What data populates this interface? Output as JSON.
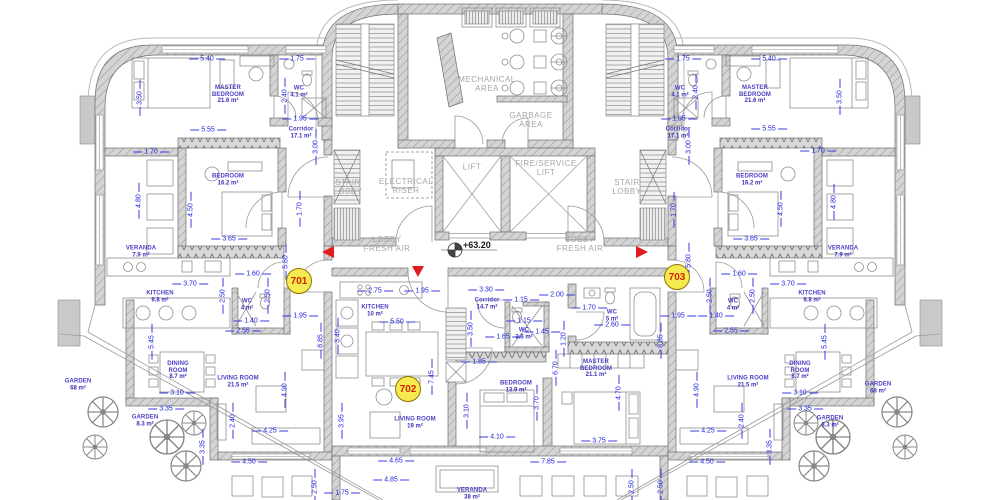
{
  "title": "residential floor plan",
  "level": {
    "text": "+63.20"
  },
  "colors": {
    "dimension_text": "#1d1de0",
    "room_label": "#4a3fc4",
    "core_label": "#a6a6a6",
    "wall_fill": "#d4d4d4",
    "unit_badge_bg": "#f6ea51",
    "unit_badge_border": "#8f7400",
    "unit_badge_text": "#d42300",
    "marker_red": "#e01c1c"
  },
  "units": [
    {
      "no": "701",
      "x": 299,
      "y": 281
    },
    {
      "no": "702",
      "x": 408,
      "y": 389
    },
    {
      "no": "703",
      "x": 677,
      "y": 277
    }
  ],
  "core_labels": [
    {
      "t": "MECHANICAL\nAREA",
      "x": 487,
      "y": 84
    },
    {
      "t": "GARBAGE\nAREA",
      "x": 531,
      "y": 120
    },
    {
      "t": "LIFT",
      "x": 472,
      "y": 167
    },
    {
      "t": "FIRE/SERVICE\nLIFT",
      "x": 546,
      "y": 168
    },
    {
      "t": "STAIR\nLOBBY",
      "x": 348,
      "y": 187
    },
    {
      "t": "ELECTRICAL\nRISER",
      "x": 406,
      "y": 186
    },
    {
      "t": "STAIR\nLOBBY",
      "x": 627,
      "y": 187
    },
    {
      "t": "LOBBY\nFRESH AIR",
      "x": 387,
      "y": 244
    },
    {
      "t": "LOBBY\nFRESH AIR",
      "x": 580,
      "y": 244
    }
  ],
  "rooms": [
    {
      "n": "MASTER\nBEDROOM",
      "a": "21.6 m²",
      "x": 228,
      "y": 95
    },
    {
      "n": "WC",
      "a": "4.1 m²",
      "x": 299,
      "y": 92
    },
    {
      "n": "Corridor",
      "a": "17.1 m²",
      "x": 301,
      "y": 133
    },
    {
      "n": "BEDROOM",
      "a": "16.2 m²",
      "x": 228,
      "y": 180
    },
    {
      "n": "VERANDA",
      "a": "7.9 m²",
      "x": 141,
      "y": 252
    },
    {
      "n": "KITCHEN",
      "a": "9.8 m²",
      "x": 160,
      "y": 297
    },
    {
      "n": "WC",
      "a": "4 m²",
      "x": 247,
      "y": 305
    },
    {
      "n": "DINING\nROOM",
      "a": "8.7 m²",
      "x": 178,
      "y": 371
    },
    {
      "n": "LIVING ROOM",
      "a": "21.5 m²",
      "x": 238,
      "y": 382
    },
    {
      "n": "GARDEN",
      "a": "68 m²",
      "x": 78,
      "y": 385
    },
    {
      "n": "GARDEN",
      "a": "8.3 m²",
      "x": 145,
      "y": 421
    },
    {
      "n": "KITCHEN",
      "a": "10 m²",
      "x": 375,
      "y": 311
    },
    {
      "n": "Corridor",
      "a": "14.7 m²",
      "x": 487,
      "y": 304
    },
    {
      "n": "WC",
      "a": "3.6 m²",
      "x": 524,
      "y": 334
    },
    {
      "n": "WC",
      "a": "5 m²",
      "x": 612,
      "y": 316
    },
    {
      "n": "BEDROOM",
      "a": "13.9 m²",
      "x": 516,
      "y": 387
    },
    {
      "n": "MASTER\nBEDROOM",
      "a": "21.1 m²",
      "x": 596,
      "y": 369
    },
    {
      "n": "LIVING ROOM",
      "a": "19 m²",
      "x": 415,
      "y": 423
    },
    {
      "n": "VERANDA",
      "a": "38 m²",
      "x": 472,
      "y": 494
    },
    {
      "n": "WC",
      "a": "4.1 m²",
      "x": 680,
      "y": 92
    },
    {
      "n": "MASTER\nBEDROOM",
      "a": "21.6 m²",
      "x": 755,
      "y": 95
    },
    {
      "n": "Corridor",
      "a": "17.1 m²",
      "x": 678,
      "y": 133
    },
    {
      "n": "BEDROOM",
      "a": "16.2 m²",
      "x": 752,
      "y": 180
    },
    {
      "n": "VERANDA",
      "a": "7.9 m²",
      "x": 843,
      "y": 252
    },
    {
      "n": "KITCHEN",
      "a": "9.8 m²",
      "x": 812,
      "y": 297
    },
    {
      "n": "WC",
      "a": "4 m²",
      "x": 733,
      "y": 305
    },
    {
      "n": "DINING\nROOM",
      "a": "8.7 m²",
      "x": 800,
      "y": 371
    },
    {
      "n": "LIVING ROOM",
      "a": "21.5 m²",
      "x": 748,
      "y": 382
    },
    {
      "n": "GARDEN",
      "a": "68 m²",
      "x": 878,
      "y": 388
    },
    {
      "n": "GARDEN",
      "a": "8.3 m²",
      "x": 830,
      "y": 422
    }
  ],
  "dimensions": [
    [
      "5.40",
      207,
      59,
      0
    ],
    [
      "1.75",
      297,
      59,
      0
    ],
    [
      "3.50",
      140,
      98,
      1
    ],
    [
      "2.40",
      285,
      96,
      1
    ],
    [
      "1.95",
      300,
      119,
      0
    ],
    [
      "5.55",
      208,
      130,
      0
    ],
    [
      "3.00",
      316,
      147,
      1
    ],
    [
      "1.70",
      151,
      152,
      0
    ],
    [
      "4.80",
      139,
      201,
      1
    ],
    [
      "4.50",
      191,
      210,
      1
    ],
    [
      "1.70",
      300,
      209,
      1
    ],
    [
      "3.65",
      229,
      239,
      0
    ],
    [
      "5.80",
      286,
      262,
      1
    ],
    [
      "1.60",
      253,
      274,
      0
    ],
    [
      "3.70",
      190,
      284,
      0
    ],
    [
      "2.50",
      223,
      296,
      1
    ],
    [
      "2.50",
      268,
      296,
      1
    ],
    [
      "1.40",
      251,
      321,
      0
    ],
    [
      "1.95",
      300,
      316,
      0
    ],
    [
      "2.55",
      243,
      331,
      0
    ],
    [
      "5.45",
      152,
      342,
      1
    ],
    [
      "8.85",
      321,
      341,
      1
    ],
    [
      "3.10",
      177,
      393,
      0
    ],
    [
      "3.35",
      166,
      409,
      0
    ],
    [
      "4.90",
      285,
      390,
      1
    ],
    [
      "2.40",
      233,
      421,
      1
    ],
    [
      "4.25",
      270,
      431,
      0
    ],
    [
      "3.35",
      203,
      447,
      1
    ],
    [
      "4.50",
      249,
      462,
      0
    ],
    [
      "2.50",
      315,
      487,
      1
    ],
    [
      "1.75",
      342,
      493,
      0
    ],
    [
      "2.75",
      375,
      291,
      0
    ],
    [
      "1.95",
      422,
      291,
      0
    ],
    [
      "3.30",
      486,
      290,
      0
    ],
    [
      "5.50",
      397,
      322,
      0
    ],
    [
      "3.40",
      338,
      336,
      1
    ],
    [
      "3.50",
      471,
      329,
      1
    ],
    [
      "1.15",
      521,
      300,
      0
    ],
    [
      "2.00",
      557,
      295,
      0
    ],
    [
      "1.65",
      503,
      337,
      0
    ],
    [
      "1.15",
      524,
      321,
      0
    ],
    [
      "1.45",
      542,
      332,
      0
    ],
    [
      "1.85",
      479,
      362,
      0
    ],
    [
      "1.20",
      564,
      339,
      1
    ],
    [
      "1.70",
      589,
      308,
      0
    ],
    [
      "2.60",
      612,
      325,
      0
    ],
    [
      "7.45",
      432,
      377,
      1
    ],
    [
      "3.10",
      467,
      411,
      1
    ],
    [
      "6.70",
      556,
      368,
      1
    ],
    [
      "3.95",
      342,
      421,
      1
    ],
    [
      "3.70",
      537,
      403,
      1
    ],
    [
      "4.10",
      497,
      437,
      0
    ],
    [
      "4.70",
      619,
      393,
      1
    ],
    [
      "3.75",
      599,
      441,
      0
    ],
    [
      "7.85",
      548,
      462,
      0
    ],
    [
      "4.65",
      396,
      461,
      0
    ],
    [
      "4.85",
      391,
      480,
      0
    ],
    [
      "2.50",
      632,
      487,
      1
    ],
    [
      "1.75",
      683,
      59,
      0
    ],
    [
      "5.40",
      769,
      59,
      0
    ],
    [
      "2.40",
      696,
      92,
      1
    ],
    [
      "3.50",
      840,
      97,
      1
    ],
    [
      "1.95",
      679,
      119,
      0
    ],
    [
      "5.55",
      769,
      129,
      0
    ],
    [
      "3.00",
      689,
      147,
      1
    ],
    [
      "1.70",
      818,
      151,
      0
    ],
    [
      "4.80",
      834,
      202,
      1
    ],
    [
      "4.50",
      781,
      209,
      1
    ],
    [
      "1.70",
      674,
      210,
      1
    ],
    [
      "3.65",
      751,
      239,
      0
    ],
    [
      "5.80",
      689,
      261,
      1
    ],
    [
      "1.60",
      739,
      274,
      0
    ],
    [
      "3.70",
      788,
      284,
      0
    ],
    [
      "2.50",
      710,
      296,
      1
    ],
    [
      "2.50",
      753,
      296,
      1
    ],
    [
      "1.40",
      716,
      316,
      0
    ],
    [
      "1.95",
      678,
      316,
      0
    ],
    [
      "2.55",
      731,
      331,
      0
    ],
    [
      "5.45",
      825,
      342,
      1
    ],
    [
      "8.85",
      661,
      341,
      1
    ],
    [
      "3.10",
      800,
      393,
      0
    ],
    [
      "3.35",
      805,
      409,
      0
    ],
    [
      "4.90",
      697,
      390,
      1
    ],
    [
      "2.40",
      742,
      421,
      1
    ],
    [
      "4.25",
      708,
      431,
      0
    ],
    [
      "3.35",
      770,
      447,
      1
    ],
    [
      "4.50",
      707,
      462,
      0
    ],
    [
      "2.50",
      661,
      487,
      1
    ]
  ]
}
